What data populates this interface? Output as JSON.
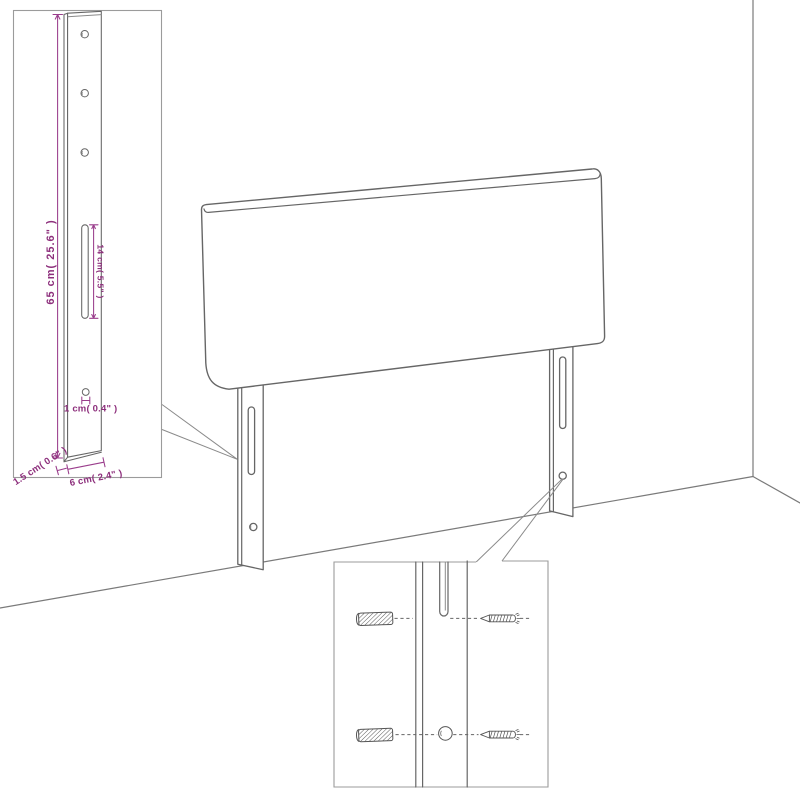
{
  "page": {
    "background_color": "#ffffff"
  },
  "colors": {
    "drawing_outline": "#666666",
    "inset_border": "#9b9b9b",
    "wall_line": "#7a7a7a",
    "dimension_line": "#9a3d8c",
    "dimension_text": "#8d2f7c",
    "hardware_line": "#555555"
  },
  "icons": {
    "wall_plug": "wall-plug-icon (hatched expansion anchor)",
    "screw": "screw-icon (pointed screw, side view)"
  },
  "insets": {
    "leg_detail": {
      "dimensions": {
        "height": "65 cm( 25.6\" )",
        "slot_length": "14 cm( 5.5\" )",
        "hole_diameter": "1 cm( 0.4\" )",
        "side_thickness": "1.5 cm( 0.6\" )",
        "leg_width": "6 cm( 2.4\" )"
      }
    },
    "mounting_detail": {}
  }
}
